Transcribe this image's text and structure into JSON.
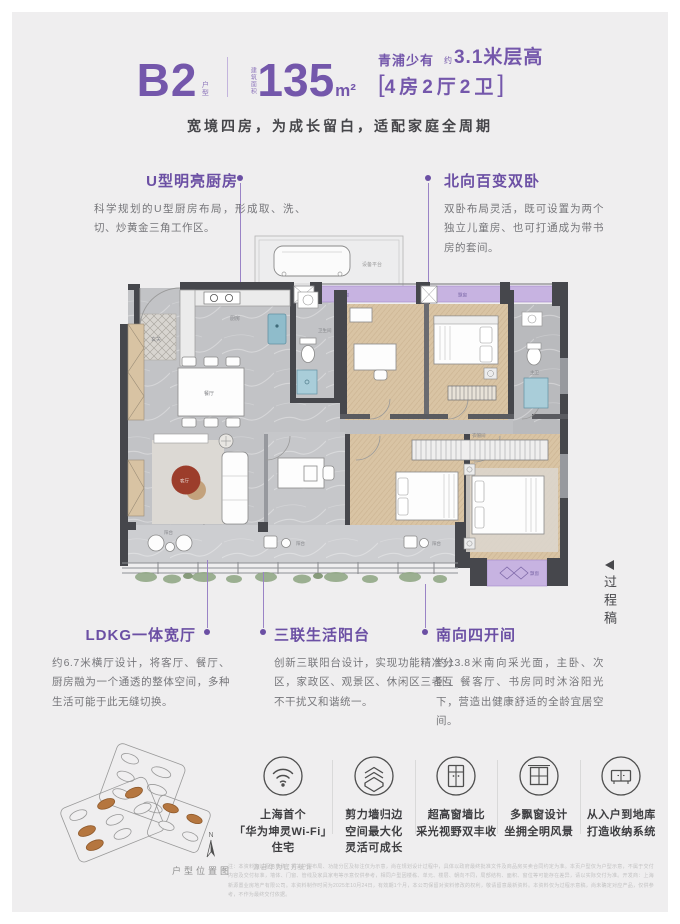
{
  "header": {
    "plan_code": "B2",
    "plan_code_suffix": "户型",
    "area_label": "建筑面积",
    "area_value": "135",
    "area_unit": "m²",
    "highlight_prefix": "青浦少有",
    "height_approx": "约",
    "height_value": "3.1米层高",
    "bracket_left": "[",
    "layout": "4房2厅2卫",
    "bracket_right": "]",
    "subtitle": "宽境四房，为成长留白，适配家庭全周期"
  },
  "callouts": {
    "kitchen": {
      "title": "U型明亮厨房",
      "desc": "科学规划的U型厨房布局，形成取、洗、切、炒黄金三角工作区。"
    },
    "north_bedrooms": {
      "title": "北向百变双卧",
      "desc": "双卧布局灵活，既可设置为两个独立儿童房、也可打通成为带书房的套间。"
    },
    "ldkg": {
      "title": "LDKG一体宽厅",
      "desc": "约6.7米横厅设计，将客厅、餐厅、厨房融为一个通透的整体空间，多种生活可能于此无缝切换。"
    },
    "triple_balcony": {
      "title": "三联生活阳台",
      "desc": "创新三联阳台设计，实现功能精准分区，家政区、观景区、休闲区三者互不干扰又和谐统一。"
    },
    "south_bays": {
      "title": "南向四开间",
      "desc": "约13.8米南向采光面，主卧、次卧、餐客厅、书房同时沐浴阳光下，营造出健康舒适的全龄宜居空间。"
    }
  },
  "floorplan": {
    "labels": {
      "equipment": "设备平台",
      "entry": "玄关",
      "kitchen": "厨房",
      "bath": "卫生间",
      "dining": "餐厅",
      "living": "客厅",
      "balcony": "阳台",
      "bay_window": "飘窗",
      "closet": "衣帽间",
      "master_bath": "主卫"
    }
  },
  "draft_note": "过程稿",
  "features": [
    {
      "icon": "wifi-icon",
      "lines": [
        "上海首个",
        "「华为坤灵Wi-Fi」",
        "住宅"
      ],
      "footnote": "源自华为官方统计"
    },
    {
      "icon": "shear-wall-icon",
      "lines": [
        "剪力墙归边",
        "空间最大化",
        "灵活可成长"
      ]
    },
    {
      "icon": "tall-window-icon",
      "lines": [
        "超高窗墙比",
        "采光视野双丰收"
      ]
    },
    {
      "icon": "bay-window-icon",
      "lines": [
        "多飘窗设计",
        "坐拥全明风景"
      ]
    },
    {
      "icon": "storage-icon",
      "lines": [
        "从入户到地库",
        "打造收纳系统"
      ]
    }
  ],
  "location_map": {
    "compass": "N",
    "caption": "户型位置图"
  },
  "disclaimer": "注：本资料为过程示意稿，相关户型布局、功能分区及标注仅为示意，尚在规划设计过程中，具体以政府最终批准文件及商品房买卖合同约定为准。本页户型仅为户型示意，不属于交付内容及交付标准，墙体、门窗、管线及家具家电等示意仅供参考，相同户型因楼栋、单元、楼层、朝向不同，局部结构、面积、窗位等可能存在差异，请以实际交付为准。开发商：上海新源置业房地产有限公司。本资料制作时间为2025年10月24日，有效期1个月，本公司保留对资料修改的权利，敬请留意最新资料。本资料仅为过程示意稿，尚未确定对应产品，仅供参考，不作为最终交付依据。"
}
